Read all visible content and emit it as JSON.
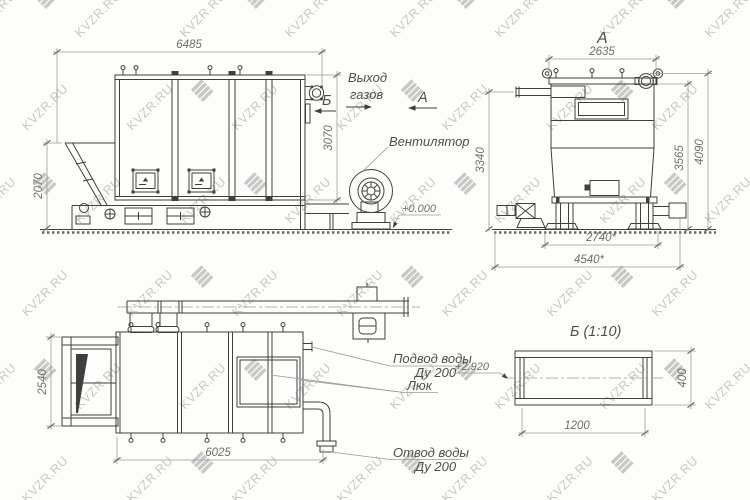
{
  "colors": {
    "line": "#3f3f3f",
    "dim": "#9a9a9a",
    "text": "#4f4f4f",
    "dim_text": "#6e6e6e",
    "watermark": "#c8c8c8",
    "background": "#fdfdfc"
  },
  "watermark": {
    "text": "KVZR.RU"
  },
  "views": {
    "side": {
      "dims": {
        "length": "6485",
        "height": "3070",
        "hopper_height": "2070"
      },
      "labels": {
        "gas_outlet_line1": "Выход",
        "gas_outlet_line2": "газов",
        "section_b": "Б",
        "view_a_arrow": "А",
        "fan": "Вентилятор",
        "ground_level": "+0.000"
      }
    },
    "view_a": {
      "title": "А",
      "dims": {
        "width": "2635",
        "height_pipe": "3340",
        "height_roof": "3565",
        "height_total": "4090",
        "base_inner": "2740*",
        "base_outer": "4540*"
      }
    },
    "plan": {
      "dims": {
        "width": "2540",
        "length": "6025"
      },
      "labels": {
        "water_inlet_line1": "Подвод воды",
        "water_inlet_line2": "Ду 200",
        "hatch": "Люк",
        "water_outlet_line1": "Отвод воды",
        "water_outlet_line2": "Ду 200"
      }
    },
    "view_b": {
      "title": "Б (1:10)",
      "dims": {
        "length": "1200",
        "height": "400",
        "elevation": "+2.920"
      }
    }
  }
}
